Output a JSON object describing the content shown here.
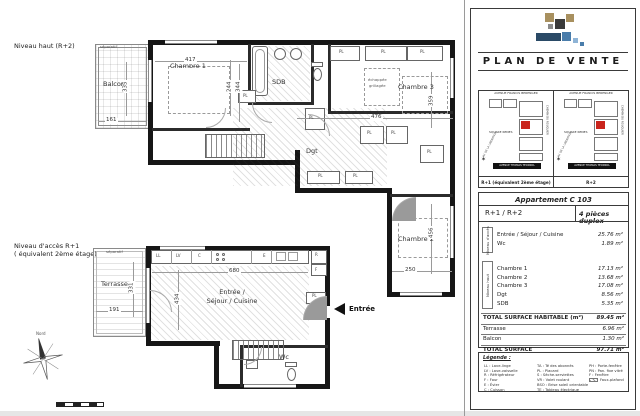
{
  "colors": {
    "accent_red": "#c9241c",
    "logo_tan": "#a8905f",
    "logo_dark": "#3a3a3a",
    "logo_gray": "#8a8a8a",
    "logo_navy": "#2a4a66",
    "logo_blue": "#4a7dab",
    "logo_lightblue": "#8fb4d6"
  },
  "upper_plan": {
    "level_label": "Niveau haut (R+2)",
    "room_labels": [
      {
        "text": "Balcon",
        "x": 103,
        "y": 81
      },
      {
        "text": "Chambre 1",
        "x": 170,
        "y": 63
      },
      {
        "text": "SDB",
        "x": 272,
        "y": 79
      },
      {
        "text": "Chambre 3",
        "x": 398,
        "y": 84
      },
      {
        "text": "Dgt",
        "x": 306,
        "y": 148
      },
      {
        "text": "Chambre 2",
        "x": 398,
        "y": 236
      }
    ],
    "dimensions": [
      {
        "text": "417",
        "x": 184,
        "y": 58
      },
      {
        "text": "344",
        "x": 233,
        "y": 84,
        "rot": -90
      },
      {
        "text": "335",
        "x": 120,
        "y": 84,
        "rot": -90
      },
      {
        "text": "161",
        "x": 105,
        "y": 118
      },
      {
        "text": "244",
        "x": 224,
        "y": 84,
        "rot": -90
      },
      {
        "text": "476",
        "x": 370,
        "y": 115
      },
      {
        "text": "359",
        "x": 426,
        "y": 98,
        "rot": -90
      },
      {
        "text": "456",
        "x": 426,
        "y": 230,
        "rot": -90
      },
      {
        "text": "250",
        "x": 404,
        "y": 268
      }
    ],
    "pl_labels": [
      {
        "text": "PL",
        "x": 339,
        "y": 50
      },
      {
        "text": "PL",
        "x": 381,
        "y": 50
      },
      {
        "text": "PL",
        "x": 420,
        "y": 50
      },
      {
        "text": "PL",
        "x": 367,
        "y": 131
      },
      {
        "text": "PL",
        "x": 391,
        "y": 131
      },
      {
        "text": "PL",
        "x": 427,
        "y": 150
      },
      {
        "text": "PL",
        "x": 318,
        "y": 174
      },
      {
        "text": "PL",
        "x": 353,
        "y": 174
      },
      {
        "text": "PL",
        "x": 243,
        "y": 94
      },
      {
        "text": "PL",
        "x": 309,
        "y": 116
      }
    ],
    "annotations": [
      {
        "text": "séparatif",
        "x": 100,
        "y": 45
      },
      {
        "text": "échappée",
        "x": 368,
        "y": 78
      },
      {
        "text": "grillagée",
        "x": 369,
        "y": 84
      }
    ]
  },
  "lower_plan": {
    "level_label_line1": "Niveau d'accès R+1",
    "level_label_line2": "( équivalent 2ème étage)",
    "room_labels": [
      {
        "text": "Terrasse",
        "x": 101,
        "y": 281
      },
      {
        "text": "Wc",
        "x": 279,
        "y": 354
      }
    ],
    "sejour_line1": "Entrée /",
    "sejour_line2": "Séjour / Cuisine",
    "dimensions": [
      {
        "text": "331",
        "x": 126,
        "y": 285,
        "rot": -90
      },
      {
        "text": "191",
        "x": 108,
        "y": 308
      },
      {
        "text": "434",
        "x": 172,
        "y": 296,
        "rot": -90
      },
      {
        "text": "680",
        "x": 228,
        "y": 269
      }
    ],
    "appliance_labels": [
      {
        "text": "LL",
        "x": 156,
        "y": 254
      },
      {
        "text": "LV",
        "x": 176,
        "y": 254
      },
      {
        "text": "C",
        "x": 198,
        "y": 254
      },
      {
        "text": "E",
        "x": 263,
        "y": 254
      },
      {
        "text": "R",
        "x": 315,
        "y": 253
      },
      {
        "text": "F",
        "x": 315,
        "y": 268
      }
    ],
    "pl_labels": [
      {
        "text": "PL",
        "x": 312,
        "y": 294
      }
    ],
    "annotations": [
      {
        "text": "séparatif",
        "x": 106,
        "y": 250
      }
    ],
    "entrance_label": "Entrée",
    "compass_label": "Nord"
  },
  "panel": {
    "title": "PLAN DE VENTE",
    "site_maps": {
      "street_top": "AVENUE FRANCIS BERENGER",
      "street_bottom": "AVENUE THOMAS TECKNOL",
      "street_left": "AV. DE LA LIBERATION",
      "street_right": "CHEMIN DU ROUQUIER",
      "square_label": "SQUARE RENES",
      "caption_left": "R+1 (équivalent 2ème étage)",
      "caption_right": "R+2"
    },
    "apartment": {
      "title": "Appartement C 103",
      "levels": "R+1 / R+2",
      "type": "4 pièces duplex",
      "sections": [
        {
          "side_label": "Niveau d'accès",
          "rows": [
            {
              "name": "Entrée / Séjour / Cuisine",
              "area": "25.76 m²"
            },
            {
              "name": "Wc",
              "area": "1.89 m²"
            }
          ]
        },
        {
          "side_label": "Niveau haut",
          "rows": [
            {
              "name": "Chambre 1",
              "area": "17.13 m²"
            },
            {
              "name": "Chambre 2",
              "area": "13.68 m²"
            },
            {
              "name": "Chambre 3",
              "area": "17.08 m²"
            },
            {
              "name": "Dgt",
              "area": "8.56 m²"
            },
            {
              "name": "SDB",
              "area": "5.35 m²"
            }
          ]
        }
      ],
      "totals": [
        {
          "label": "TOTAL SURFACE HABITABLE (m²)",
          "value": "89.45 m²",
          "cls": "b"
        },
        {
          "label": "Terrasse",
          "value": "6.96 m²"
        },
        {
          "label": "Balcon",
          "value": "1.30 m²"
        },
        {
          "label": "TOTAL SURFACE",
          "value": "97.71 m²",
          "cls": "b"
        }
      ]
    },
    "legend": {
      "title": "Légende :",
      "col1": [
        {
          "text": "LL : Lave-linge"
        },
        {
          "text": "LV : Lave-vaisselle"
        },
        {
          "text": "R : Réfrigérateur"
        },
        {
          "text": "F : Four"
        },
        {
          "text": "E : Évier"
        },
        {
          "text": "C : Cuisson"
        }
      ],
      "col2": [
        {
          "text": "TA : Té des abonnés"
        },
        {
          "text": "PL : Placard"
        },
        {
          "text": "S : Sèche-serviettes"
        },
        {
          "text": "VR : Volet roulant"
        },
        {
          "text": "BSO : Brise soleil orientable"
        },
        {
          "text": "TE : Tableau électrique"
        }
      ],
      "col3": [
        {
          "text": "PH : Porte-fenêtre"
        },
        {
          "text": "PN : Pan. fixe vitré"
        },
        {
          "text": "F : Fenêtre"
        },
        {
          "text": "Faux-plafond",
          "cls": "swatch"
        }
      ]
    }
  }
}
